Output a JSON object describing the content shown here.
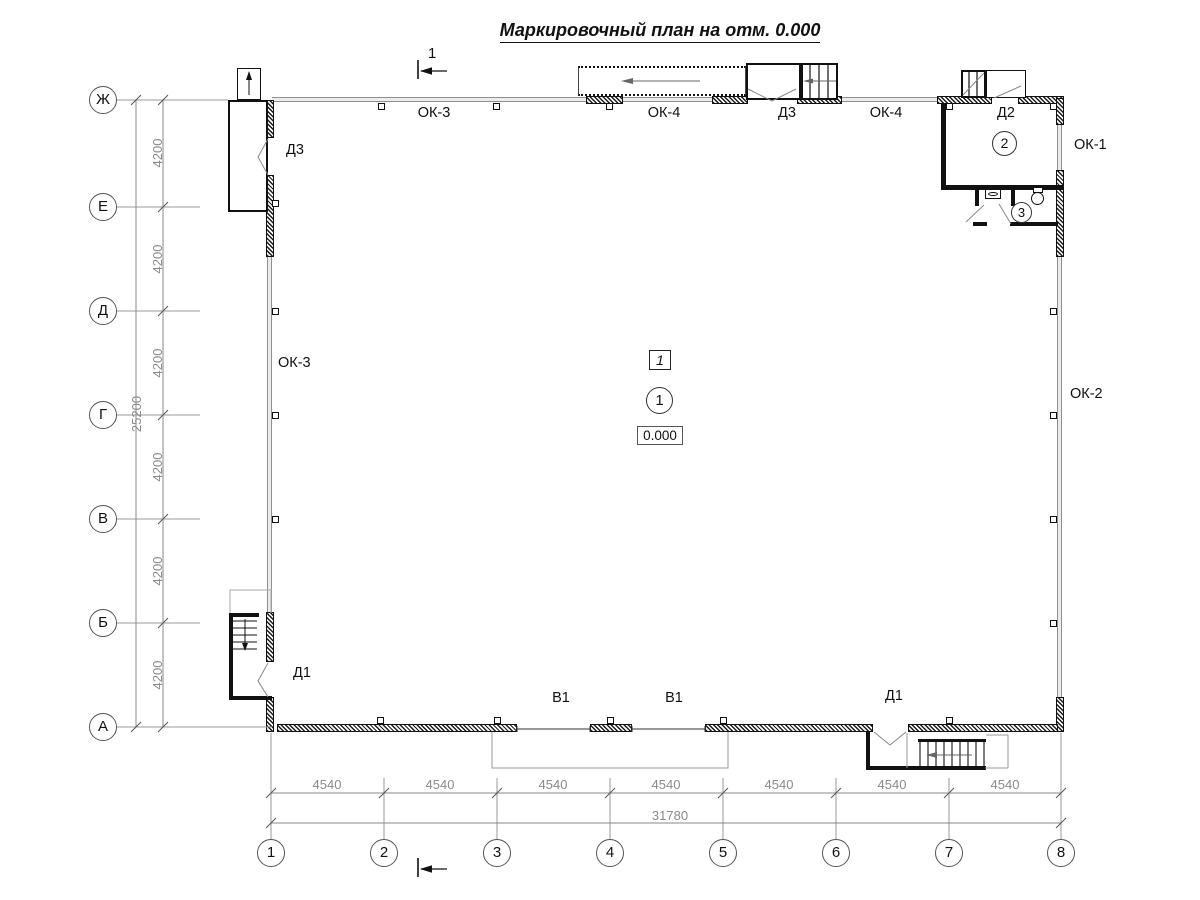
{
  "title": "Маркировочный план на отм. 0.000",
  "section": {
    "label": "1"
  },
  "axes": {
    "rows": [
      "Ж",
      "Е",
      "Д",
      "Г",
      "В",
      "Б",
      "А"
    ],
    "cols": [
      "1",
      "2",
      "3",
      "4",
      "5",
      "6",
      "7",
      "8"
    ],
    "row_spacing": [
      "4200",
      "4200",
      "4200",
      "4200",
      "4200",
      "4200"
    ],
    "row_total": "25200",
    "col_spacing": [
      "4540",
      "4540",
      "4540",
      "4540",
      "4540",
      "4540",
      "4540"
    ],
    "col_total": "31780"
  },
  "labels": {
    "ok3_top": "ОК-3",
    "ok4_top_left": "ОК-4",
    "d3_top": "Д3",
    "ok4_top_right": "ОК-4",
    "d2": "Д2",
    "ok1": "ОК-1",
    "d3_left": "Д3",
    "ok3_left": "ОК-3",
    "ok2": "ОК-2",
    "d1_left": "Д1",
    "v1_left": "В1",
    "v1_right": "В1",
    "d1_right": "Д1"
  },
  "rooms": {
    "hall": "1",
    "room2": "2",
    "wc": "3"
  },
  "marks": {
    "position_tag": "1",
    "elevation": "0.000"
  }
}
